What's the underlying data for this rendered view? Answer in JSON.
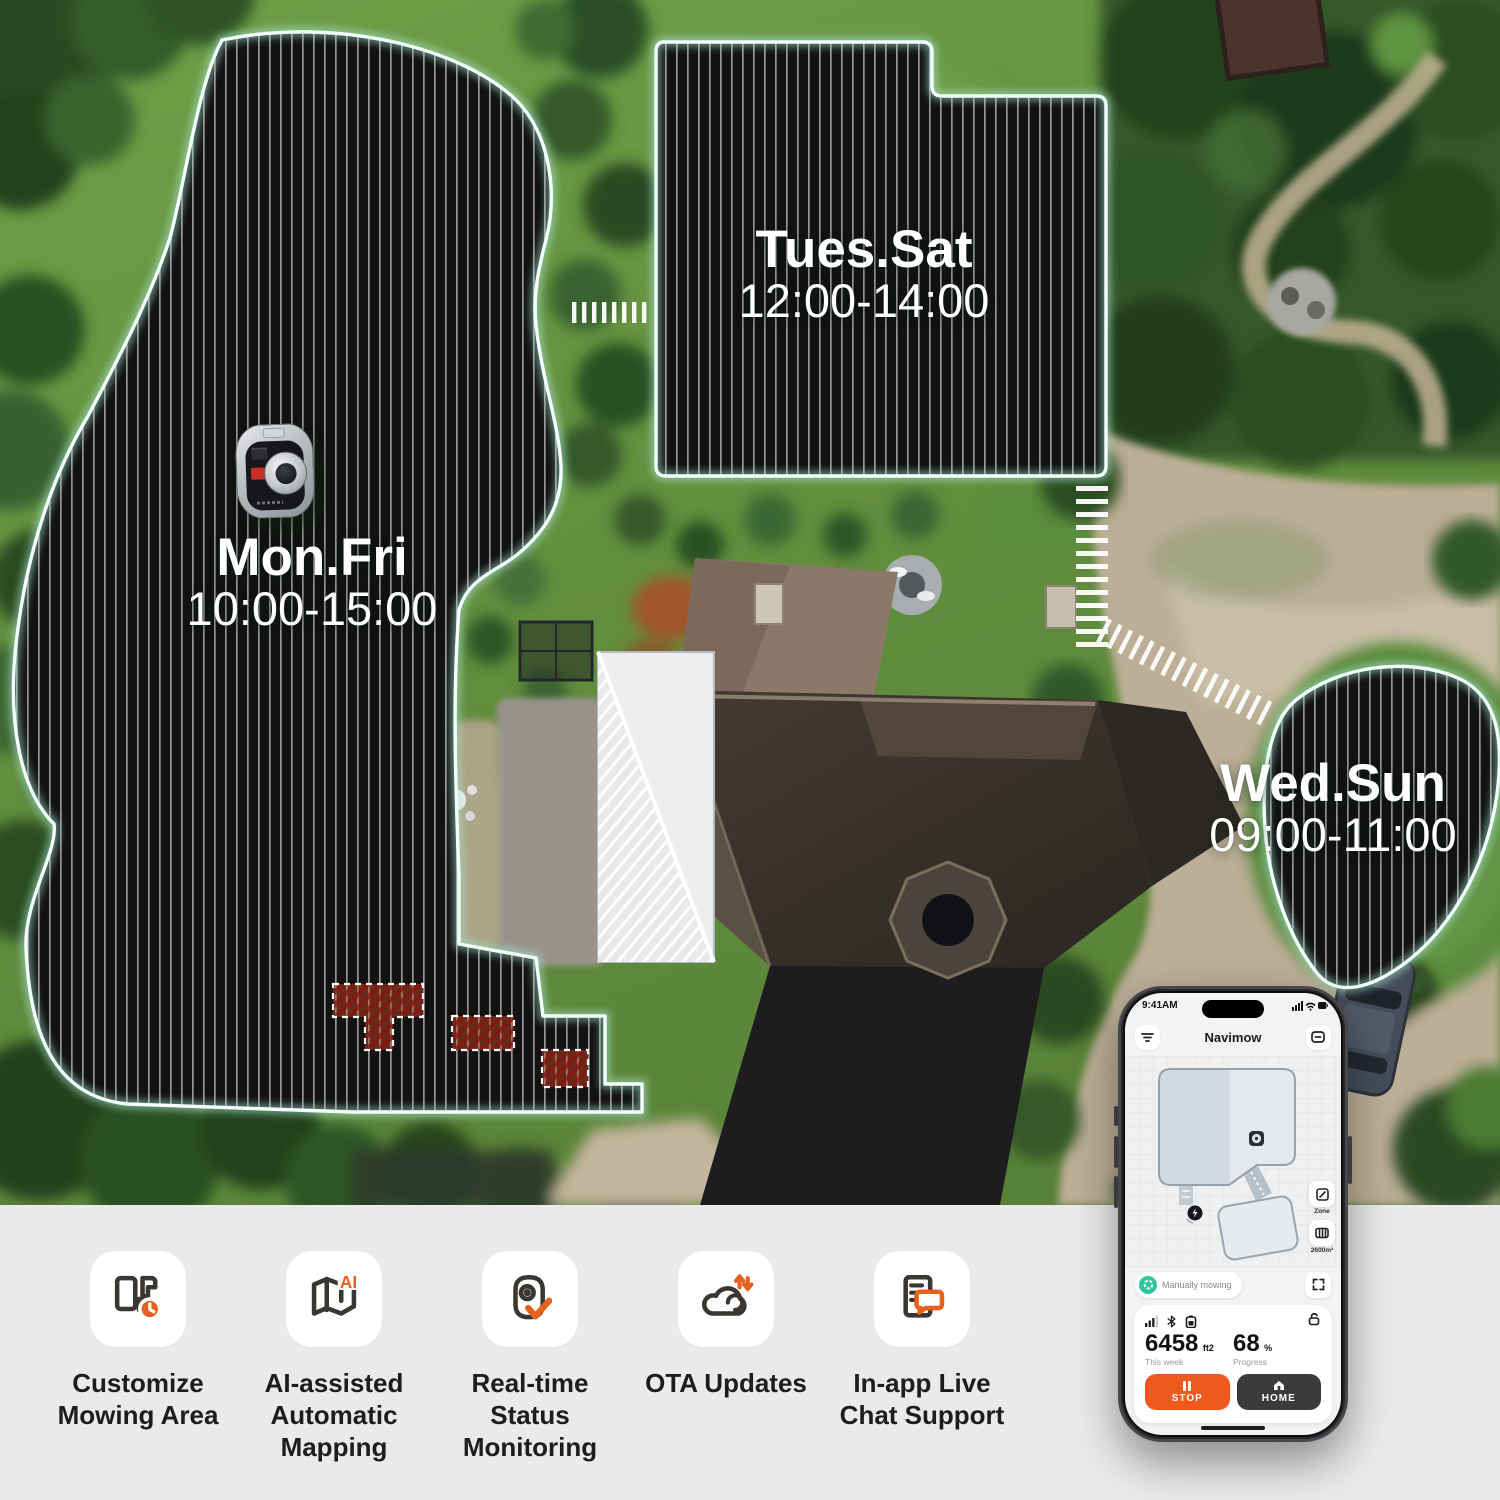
{
  "scene": {
    "zones": [
      {
        "days": "Mon.Fri",
        "time": "10:00-15:00"
      },
      {
        "days": "Tues.Sat",
        "time": "12:00-14:00"
      },
      {
        "days": "Wed.Sun",
        "time": "09:00-11:00"
      }
    ]
  },
  "features": [
    {
      "label": "Customize Mowing Area",
      "icon": "map-zones-clock-icon"
    },
    {
      "label": "AI-assisted Automatic Mapping",
      "icon": "folded-map-ai-icon",
      "badge": "AI"
    },
    {
      "label": "Real-time Status Monitoring",
      "icon": "mower-check-icon"
    },
    {
      "label": "OTA Updates",
      "icon": "cloud-sync-icon"
    },
    {
      "label": "In-app Live Chat Support",
      "icon": "document-chat-icon"
    }
  ],
  "phone": {
    "status_bar": {
      "time": "9:41AM"
    },
    "nav": {
      "title": "Navimow"
    },
    "map": {
      "zone_button_label": "Zone",
      "area_button_label": "2600m²"
    },
    "status_pill": {
      "label": "Manually mowing"
    },
    "stats": {
      "area_value": "6458",
      "area_unit": "ft2",
      "area_caption": "This week",
      "progress_value": "68",
      "progress_unit": "%",
      "progress_caption": "Progress"
    },
    "actions": {
      "stop": "STOP",
      "home": "HOME"
    }
  },
  "colors": {
    "accent_orange": "#E8611C",
    "stop_orange": "#F0591D",
    "home_dark": "#3B3B3D",
    "pill_green": "#2EC59E",
    "zone_outline": "#F2FFFB",
    "zone_glow": "#A9E6D2"
  }
}
